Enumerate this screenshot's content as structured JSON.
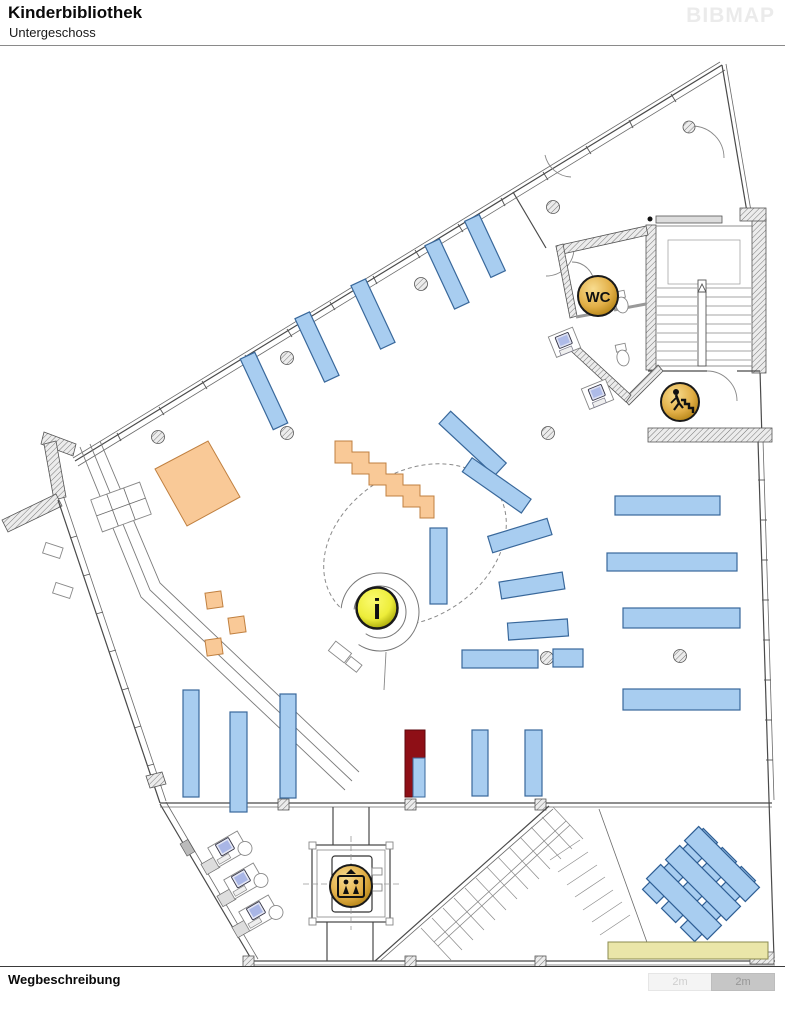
{
  "header": {
    "title": "Kinderbibliothek",
    "subtitle": "Untergeschoss",
    "logo": "BIBMAP"
  },
  "map": {
    "icons": {
      "wc": {
        "name": "wc-icon",
        "label": "WC"
      },
      "info": {
        "name": "info-icon",
        "label": "i"
      },
      "elevator": {
        "name": "elevator-icon"
      },
      "stairs": {
        "name": "stairs-icon"
      }
    },
    "colors": {
      "shelf_blue": "#A8CDF0",
      "shelf_border": "#39689B",
      "furniture_orange": "#F9C997",
      "orange_border": "#C08040",
      "highlight_red": "#8E0F16",
      "bench_yellow": "#EAE6A9",
      "icon_gold": "#E2AF47",
      "info_yellow": "#EDED3A",
      "wall_gray": "#4A4A4A"
    }
  },
  "footer": {
    "label": "Wegbeschreibung"
  },
  "scale_bar": {
    "segments": [
      {
        "label": "2m"
      },
      {
        "label": "2m"
      }
    ]
  }
}
